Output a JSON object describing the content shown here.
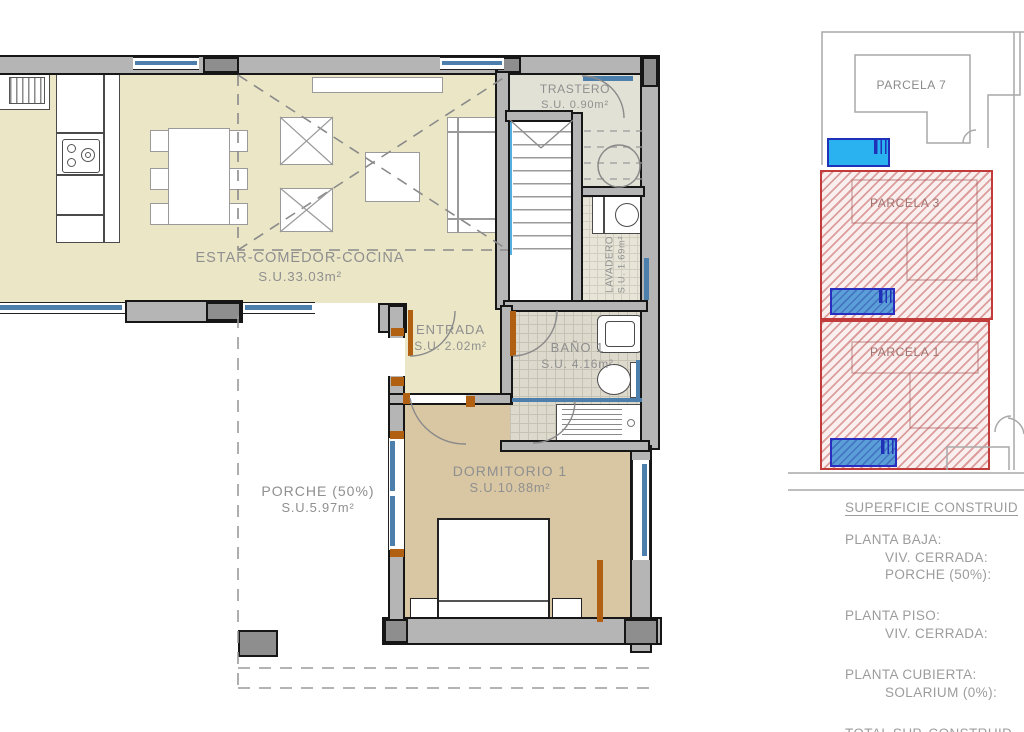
{
  "floor_plan": {
    "rooms": {
      "estar": {
        "name": "ESTAR-COMEDOR-COCINA",
        "area": "S.U.33.03m²"
      },
      "trastero": {
        "name": "TRASTERO",
        "area": "S.U. 0.90m²"
      },
      "lavadero": {
        "name": "LAVADERO",
        "area": "S.U. 1.69m²"
      },
      "entrada": {
        "name": "ENTRADA",
        "area": "S.U. 2.02m²"
      },
      "bano": {
        "name": "BAÑO 1",
        "area": "S.U. 4.16m²"
      },
      "dormitorio": {
        "name": "DORMITORIO 1",
        "area": "S.U.10.88m²"
      },
      "porche": {
        "name": "PORCHE (50%)",
        "area": "S.U.5.97m²"
      }
    }
  },
  "site_plan": {
    "parcels": {
      "p7": {
        "label": "PARCELA 7"
      },
      "p3": {
        "label": "PARCELA 3"
      },
      "p1": {
        "label": "PARCELA 1"
      }
    }
  },
  "legend": {
    "title": "SUPERFICIE CONSTRUID",
    "groups": [
      {
        "heading": "PLANTA BAJA:",
        "item1": "VIV. CERRADA:",
        "item2": "PORCHE (50%):"
      },
      {
        "heading": "PLANTA PISO:",
        "item1": "VIV. CERRADA:"
      },
      {
        "heading": "PLANTA CUBIERTA:",
        "item1": "SOLARIUM (0%):"
      },
      {
        "heading": "TOTAL SUP. CONSTRUID"
      }
    ]
  },
  "colors": {
    "living_floor": "#eae6c6",
    "bedroom_floor": "#d9c7a4",
    "service_floor": "#e2e1d5",
    "wall_gray": "#b5b5b5",
    "window_blue": "#4d7fad",
    "stair_blue": "#54aede",
    "door_orange": "#b06010",
    "parcel_red": "#c23b3b",
    "pool_blue": "#29b2ef",
    "pool_hatch_blue": "#5b9fd8",
    "label_gray": "#8f8f8f"
  }
}
